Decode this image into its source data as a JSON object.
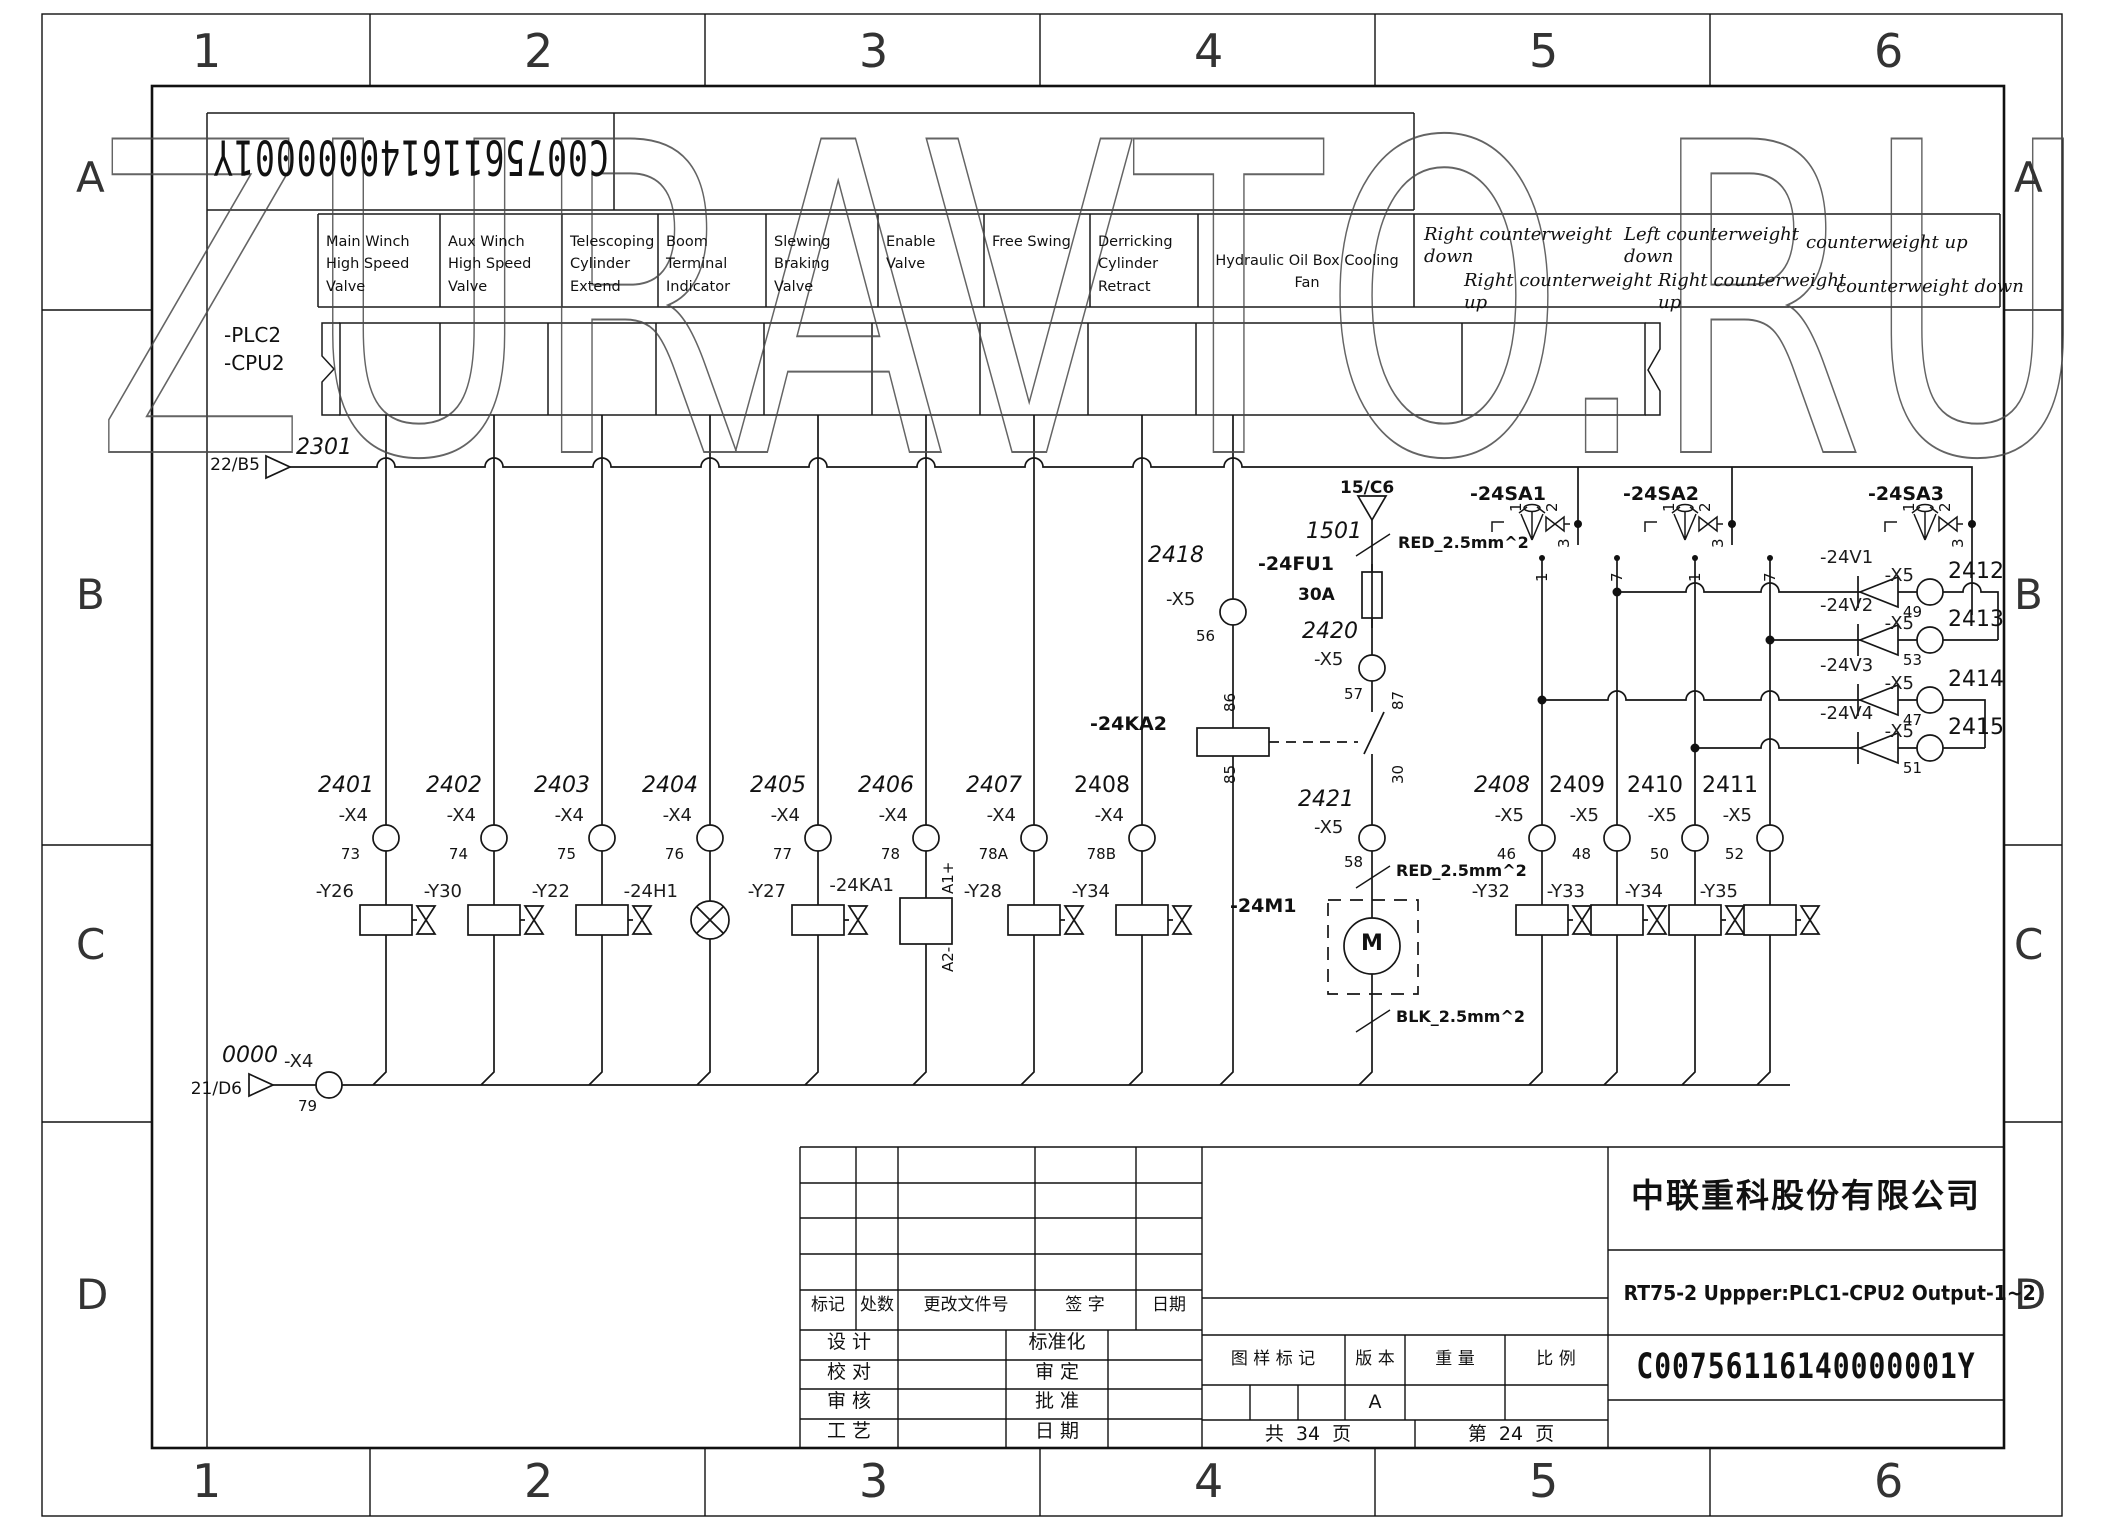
{
  "watermark": "ZURAVTO.RU",
  "sheet": {
    "zones_top": [
      "1",
      "2",
      "3",
      "4",
      "5",
      "6"
    ],
    "zones_side": [
      "A",
      "B",
      "C",
      "D"
    ],
    "doc_number_rotated": "C00756116140000001Y"
  },
  "plc": {
    "line1": "-PLC2",
    "line2": "-CPU2"
  },
  "header": {
    "functions": [
      "Main Winch High Speed Valve",
      "Aux Winch High Speed Valve",
      "Telescoping Cylinder Extend",
      "Boom Terminal Indicator",
      "Slewing Braking Valve",
      "Enable Valve",
      "Free Swing",
      "Derricking Cylinder Retract",
      "Hydraulic Oil Box Cooling Fan"
    ],
    "counterweight": [
      "Right counterweight\ndown",
      "Right counterweight\nup",
      "Left counterweight\ndown",
      "Right counterweight\nup",
      "counterweight up",
      "counterweight down"
    ]
  },
  "bus_top": {
    "ref": "22/B5",
    "wire": "2301"
  },
  "bus_bottom": {
    "ref": "21/D6",
    "wire": "0000",
    "terminal": "-X4",
    "pin": "79"
  },
  "left_circuits": [
    {
      "wire": "2401",
      "terminal": "-X4",
      "pin": "73",
      "device": "-Y26"
    },
    {
      "wire": "2402",
      "terminal": "-X4",
      "pin": "74",
      "device": "-Y30"
    },
    {
      "wire": "2403",
      "terminal": "-X4",
      "pin": "75",
      "device": "-Y22"
    },
    {
      "wire": "2404",
      "terminal": "-X4",
      "pin": "76",
      "device": "-24H1"
    },
    {
      "wire": "2405",
      "terminal": "-X4",
      "pin": "77",
      "device": "-Y27"
    },
    {
      "wire": "2406",
      "terminal": "-X4",
      "pin": "78",
      "device": "-24KA1",
      "a1": "A1+",
      "a2": "A2-"
    },
    {
      "wire": "2407",
      "terminal": "-X4",
      "pin": "78A",
      "device": "-Y28"
    },
    {
      "wire": "2408",
      "terminal": "-X4",
      "pin": "78B",
      "device": "-Y34"
    }
  ],
  "right_circuits": [
    {
      "wire": "2408",
      "terminal": "-X5",
      "pin": "46",
      "device": "-Y32"
    },
    {
      "wire": "2409",
      "terminal": "-X5",
      "pin": "48",
      "device": "-Y33"
    },
    {
      "wire": "2410",
      "terminal": "-X5",
      "pin": "50",
      "device": "-Y34"
    },
    {
      "wire": "2411",
      "terminal": "-X5",
      "pin": "52",
      "device": "-Y35"
    }
  ],
  "right_pins": [
    "1",
    "7",
    "1",
    "7"
  ],
  "diode_rows": [
    {
      "device": "-24V1",
      "terminal": "-X5",
      "pin": "49",
      "wire": "2412"
    },
    {
      "device": "-24V2",
      "terminal": "-X5",
      "pin": "53",
      "wire": "2413"
    },
    {
      "device": "-24V3",
      "terminal": "-X5",
      "pin": "47",
      "wire": "2414"
    },
    {
      "device": "-24V4",
      "terminal": "-X5",
      "pin": "51",
      "wire": "2415"
    }
  ],
  "selector_switches": [
    {
      "name": "-24SA1",
      "positions": [
        "1",
        "0",
        "2"
      ],
      "contact_pin": "3"
    },
    {
      "name": "-24SA2",
      "positions": [
        "1",
        "0",
        "2"
      ],
      "contact_pin": "3"
    },
    {
      "name": "-24SA3",
      "positions": [
        "1",
        "0",
        "2"
      ],
      "contact_pin": "3"
    }
  ],
  "middle": {
    "ka2": {
      "wire": "2418",
      "terminal": "-X5",
      "pin": "56",
      "pin_top": "86",
      "coil": "-24KA2",
      "pin_bottom": "85"
    },
    "feed": {
      "ref": "15/C6",
      "wire1": "1501",
      "spec_top": "RED_2.5mm^2",
      "fuse": "-24FU1",
      "fuse_rating": "30A",
      "wire2": "2420",
      "term2": "-X5",
      "pin2": "57",
      "contact_top": "87",
      "contact_bottom": "30",
      "wire3": "2421",
      "term3": "-X5",
      "pin3": "58",
      "spec_mid": "RED_2.5mm^2",
      "motor": "-24M1",
      "motor_letter": "M",
      "spec_bottom": "BLK_2.5mm^2"
    }
  },
  "title_block": {
    "company": "中联重科股份有限公司",
    "drawing_title": "RT75-2 Uppper:PLC1-CPU2 Output-1~2",
    "doc_number": "C00756116140000001Y",
    "rev_header": [
      "标记",
      "处数",
      "更改文件号",
      "签 字",
      "日期"
    ],
    "sign_rows": [
      [
        "设 计",
        "标准化"
      ],
      [
        "校 对",
        "审 定"
      ],
      [
        "审 核",
        "批 准"
      ],
      [
        "工 艺",
        "日 期"
      ]
    ],
    "stamp_header": [
      "图 样 标 记",
      "版 本",
      "重 量",
      "比 例"
    ],
    "version": "A",
    "total_pages": "共  34  页",
    "page": "第  24  页"
  }
}
